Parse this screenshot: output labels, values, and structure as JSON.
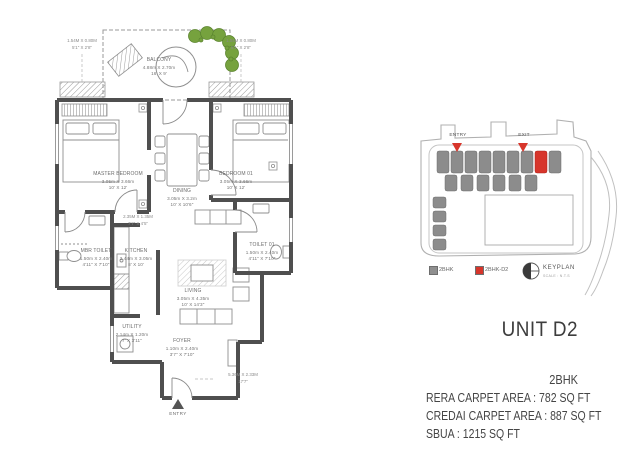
{
  "floor_plan": {
    "rooms": {
      "balcony": {
        "name": "BALCONY",
        "metric": "4.88m X 2.70m",
        "imperial": "16' X 9'"
      },
      "master_bedroom": {
        "name": "MASTER BEDROOM",
        "metric": "3.05m X 3.66m",
        "imperial": "10' X 12'"
      },
      "bedroom_01": {
        "name": "BEDROOM 01",
        "metric": "3.05m X 3.66m",
        "imperial": "10' X 12'"
      },
      "dining": {
        "name": "DINING",
        "metric": "3.05m X 3.2m",
        "imperial": "10' X 10'6\""
      },
      "kitchen": {
        "name": "KITCHEN",
        "metric": "2.44m X 3.05m",
        "imperial": "8' X 10'"
      },
      "mbr_toilet": {
        "name": "MBR TOILET",
        "metric": "1.50m X 2.40m",
        "imperial": "4'11\" X 7'10\""
      },
      "toilet_01": {
        "name": "TOILET 01",
        "metric": "1.50m X 2.40m",
        "imperial": "4'11\" X 7'10\""
      },
      "living": {
        "name": "LIVING",
        "metric": "3.05m X 4.35m",
        "imperial": "10' X 14'3\""
      },
      "utility": {
        "name": "UTILITY",
        "metric": "2.14m X 1.20m",
        "imperial": "7' X 3'11\""
      },
      "foyer": {
        "name": "FOYER",
        "metric": "1.10m X 2.40m",
        "imperial": "3'7\" X 7'10\""
      }
    },
    "dimensions": {
      "top_left": {
        "metric": "1.54M X 0.80M",
        "imperial": "5'1\" X 2'8\""
      },
      "top_right": {
        "metric": "1.54M X 0.80M",
        "imperial": "5'1\" X 2'8\""
      },
      "passage": {
        "metric": "2.35M X 1.35M",
        "imperial": "7'7\" X 4'5\""
      },
      "bottom": {
        "metric": "5.36M X 2.33M",
        "imperial": "17'7\""
      }
    },
    "entry_label": "ENTRY"
  },
  "key_plan": {
    "entry_label": "ENTRY",
    "exit_label": "EXIT",
    "legend": [
      {
        "label": "2BHK",
        "color": "#8f8f8f"
      },
      {
        "label": "2BHK-D2",
        "color": "#d7352b"
      }
    ],
    "compass_label": "KEYPLAN",
    "compass_sub": "SCALE : N.T.S"
  },
  "unit_info": {
    "title": "UNIT D2",
    "type": "2BHK",
    "rera": "RERA CARPET AREA : 782 SQ FT",
    "credai": "CREDAI CARPET AREA : 887 SQ FT",
    "sbua": "SBUA : 1215 SQ FT"
  },
  "colors": {
    "accent_red": "#d7352b",
    "plant_green": "#76a23e",
    "wall_gray": "#4f4f4f"
  }
}
